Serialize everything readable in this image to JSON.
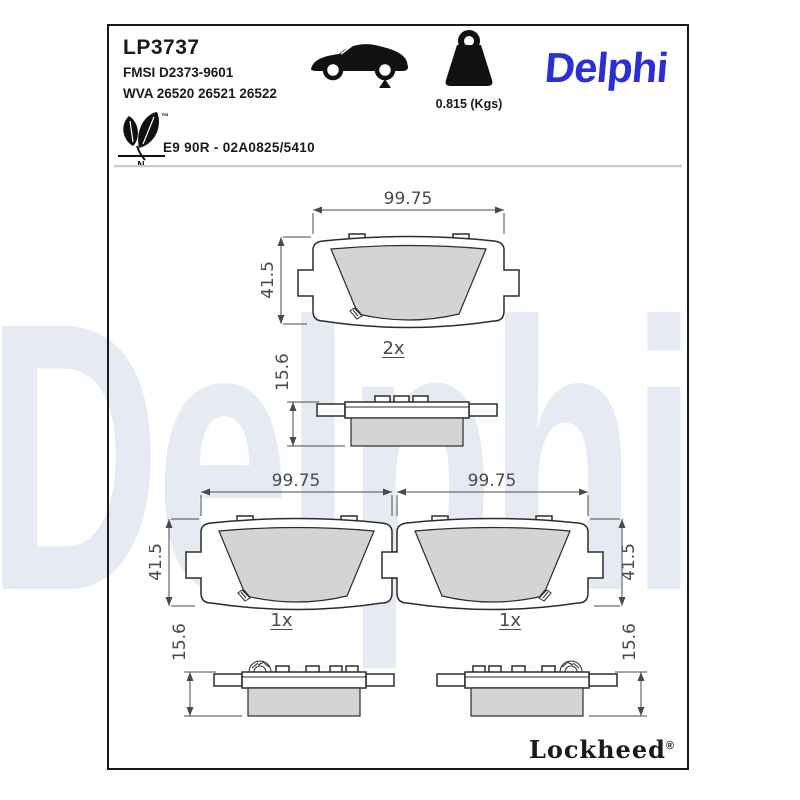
{
  "page": {
    "part_number": "LP3737",
    "fmsi": "FMSI D2373-9601",
    "wva": "WVA 26520 26521 26522",
    "weight_label": "0.815 (Kgs)",
    "brand_logo": "Delphi",
    "eco_tm": "™",
    "eco_letter": "N",
    "approval": "E9 90R - 02A0825/5410",
    "watermark": "Delphi",
    "footer_brand": "Lockheed",
    "footer_reg": "®"
  },
  "drawings": {
    "front_top": {
      "width": "99.75",
      "height": "41.5",
      "qty": "2x"
    },
    "side_top": {
      "thickness": "15.6"
    },
    "front_left": {
      "width": "99.75",
      "height": "41.5",
      "qty": "1x"
    },
    "front_right": {
      "width": "99.75",
      "height": "41.5",
      "qty": "1x"
    },
    "side_left": {
      "thickness": "15.6"
    },
    "side_right": {
      "thickness": "15.6"
    }
  },
  "colors": {
    "delphi_blue": "#2B2ED6",
    "watermark_blue": "#E5EAF3",
    "friction_gray": "#D4D4D4",
    "outline_dark": "#2B2B2B",
    "dimension_gray": "#4A4A4A"
  }
}
